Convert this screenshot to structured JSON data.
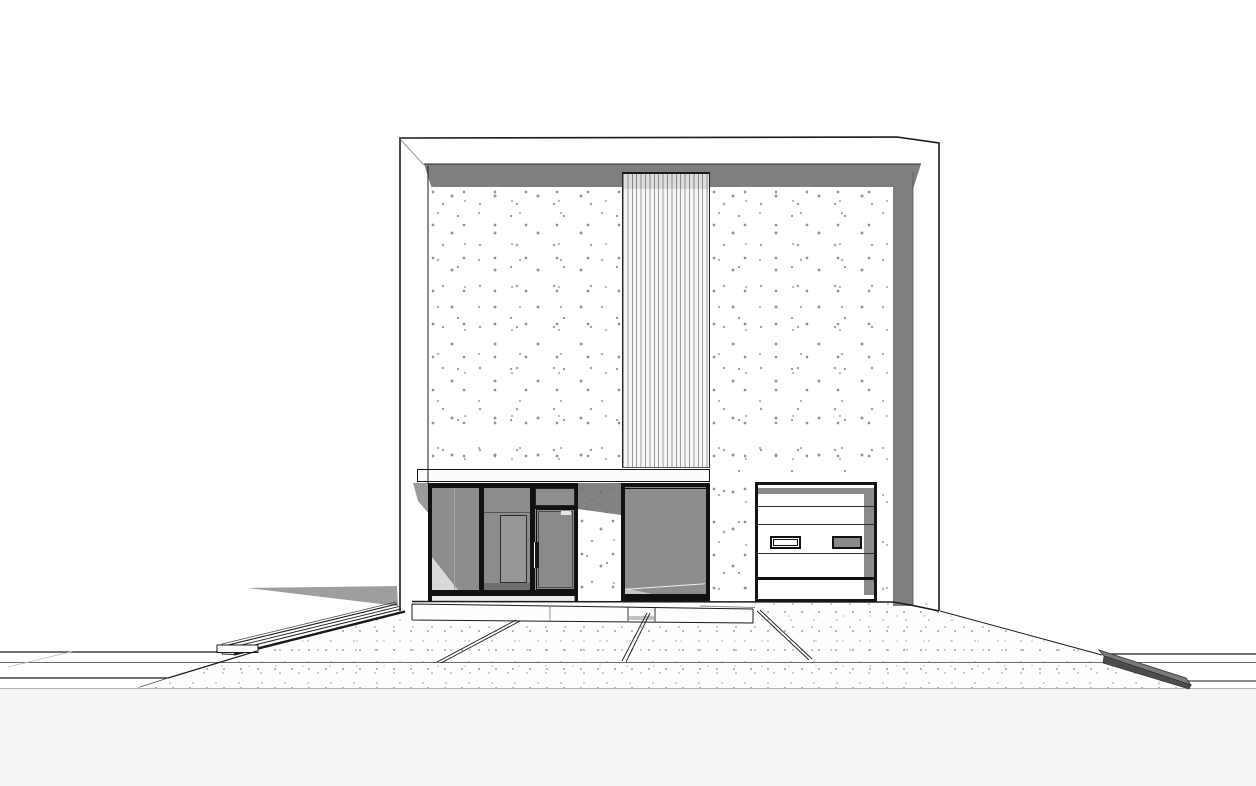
{
  "meta": {
    "type": "architectural-elevation-render",
    "view": "front-elevation-of-modern-two-storey-house",
    "visible_text": "none"
  },
  "canvas": {
    "width": 1256,
    "height": 786,
    "background": "#ffffff"
  },
  "palette": {
    "outline": "#1a1a1a",
    "parapet_fascia_band": "#7f7f7f",
    "right_side_return": "#7f7f7f",
    "glass": "#8d8d8d",
    "glass_reflection_light": "#c6c6c6",
    "wall_speckle_dot": "#969696",
    "driveway_dot": "#b0b0b0",
    "cast_shadow": "#9e9e9e",
    "under_canopy_shadow": "#9b9b9b",
    "curb_top_face": "#7a7a7a",
    "curb_front_face": "#4c4c4c",
    "canopy": "#fcfcfc",
    "garage_door_panel": "#ffffff",
    "garage_door_shadow_strip": "#8a8a8a",
    "garage_window_right_glass": "#898989",
    "foreground_strip": "#f4f4f4"
  },
  "components": [
    "building-outline",
    "parapet-fascia-band",
    "left-concrete-wall",
    "vertical-slat-cladding",
    "right-concrete-wall",
    "right-side-return",
    "entry-canopy",
    "storefront-glazing",
    "entry-door",
    "door-handle",
    "concrete-pier",
    "garage-door",
    "garage-window-left",
    "garage-window-right",
    "porch-slab",
    "entry-steps",
    "driveway",
    "paving-joints",
    "left-sidewalk-curb",
    "right-street-curb",
    "building-cast-shadow"
  ]
}
